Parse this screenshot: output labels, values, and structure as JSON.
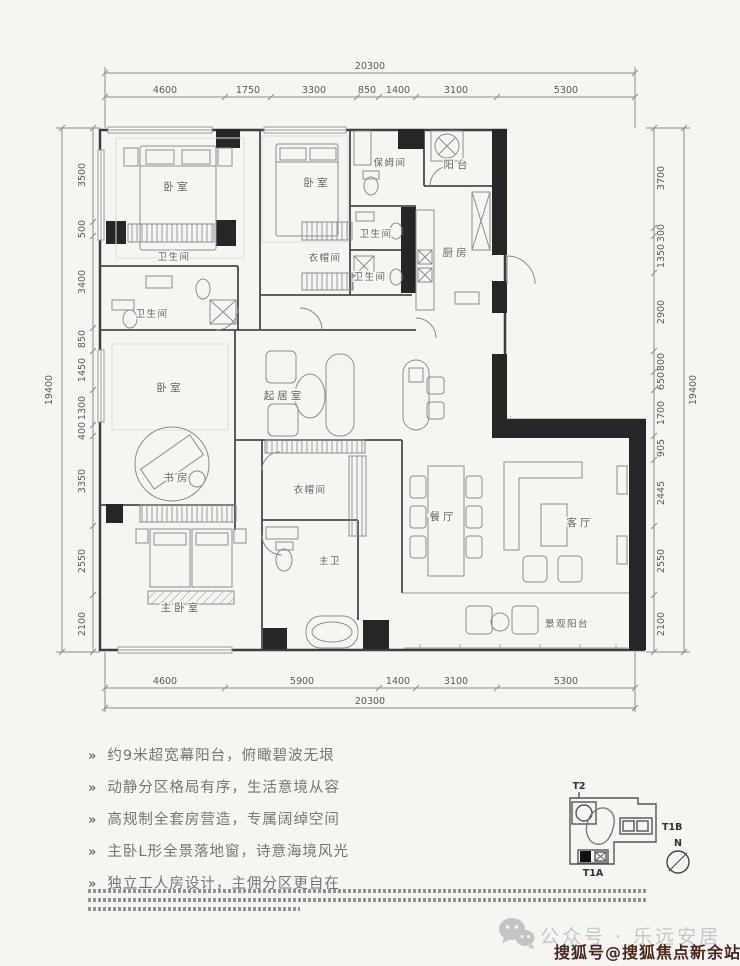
{
  "plan": {
    "rooms": {
      "bedroom1": "卧室",
      "bedroom2": "卧室",
      "nanny": "保姆间",
      "balcony_top": "阳台",
      "bath1": "卫生间",
      "bath2": "卫生间",
      "bath3": "卫生间",
      "bath4": "卫生间",
      "cloak1": "衣帽间",
      "kitchen": "厨房",
      "family": "起居室",
      "bedroom3": "卧室",
      "study": "书房",
      "master": "主卧室",
      "cloak2": "衣帽间",
      "master_bath": "主卫",
      "dining": "餐厅",
      "living": "客厅",
      "view_balcony": "景观阳台"
    },
    "dims": {
      "top": {
        "total": "20300",
        "segments": [
          "4600",
          "1750",
          "3300",
          "850",
          "1400",
          "3100",
          "5300"
        ]
      },
      "bottom": {
        "total": "20300",
        "segments": [
          "4600",
          "5900",
          "1400",
          "3100",
          "5300"
        ]
      },
      "left": {
        "total": "19400",
        "segments": [
          "3500",
          "500",
          "3400",
          "850",
          "1450",
          "1300",
          "400",
          "3350",
          "2550",
          "2100"
        ]
      },
      "right": {
        "total": "19400",
        "segments": [
          "3700",
          "300",
          "1350",
          "2900",
          "800",
          "650",
          "1700",
          "905",
          "2445",
          "2550",
          "2100"
        ]
      }
    }
  },
  "features": {
    "marker": "»",
    "items": [
      "约9米超宽幕阳台，俯瞰碧波无垠",
      "动静分区格局有序，生活意境从容",
      "高规制全套房营造，专属阔绰空间",
      "主卧L形全景落地窗，诗意海境风光",
      "独立工人房设计，主佣分区更自在"
    ]
  },
  "keyplan": {
    "t2": "T2",
    "t1b": "T1B",
    "t1a": "T1A",
    "north_label": "N"
  },
  "watermark": {
    "wechat_account": "公众号 · 乐远安居",
    "sohu_account": "搜狐号@搜狐焦点新余站"
  },
  "colors": {
    "sohu_red": "#4a2620",
    "wall_black": "#262626"
  }
}
